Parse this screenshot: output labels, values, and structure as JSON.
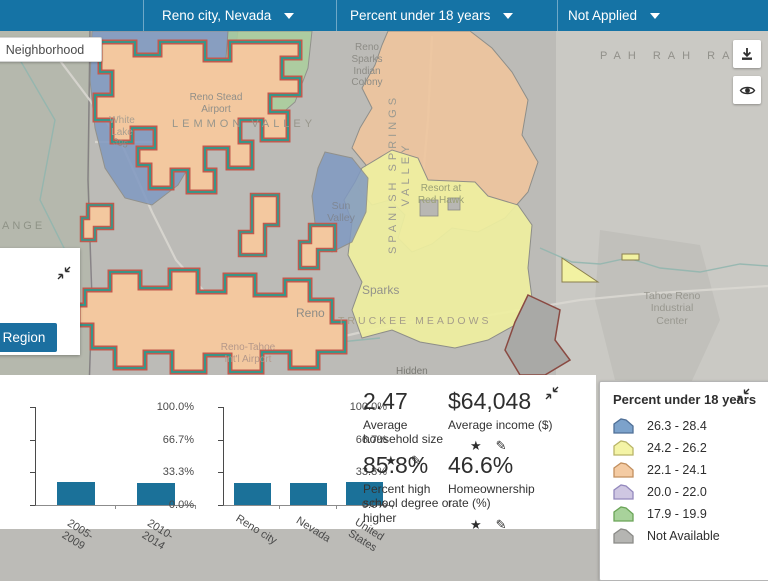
{
  "header": {
    "selectors": [
      {
        "label": "Reno city, Nevada"
      },
      {
        "label": "Percent under 18 years"
      },
      {
        "label": "Not Applied"
      }
    ]
  },
  "map": {
    "mode_button": "Neighborhood",
    "edit_button": "Edit Region",
    "labels": {
      "pah_rah": "PAH RAH RAN",
      "reno_sparks_colony": "Reno Sparks Indian Colony",
      "reno_stead": "Reno Stead Airport",
      "white_lake": "White Lake",
      "lemmon_valley": "LEMMON VALLEY",
      "spanish_springs": "SPANISH SPRINGS VALLEY",
      "sun_valley": "Sun Valley",
      "red_hawk": "Resort at Red Hawk",
      "sparks": "Sparks",
      "reno": "Reno",
      "truckee": "TRUCKEE MEADOWS",
      "reno_tahoe": "Reno-Tahoe Int'l Airport",
      "hidden": "Hidden",
      "tahoe_industrial": "Tahoe Reno Industrial Center",
      "ange": "ANGE",
      "hwy": "395"
    }
  },
  "legend": {
    "title": "Percent under 18 years",
    "items": [
      {
        "label": "26.3 - 28.4",
        "fill": "#7ca2cb",
        "stroke": "#4f6f96"
      },
      {
        "label": "24.2 - 26.2",
        "fill": "#f4f4a6",
        "stroke": "#b9b568"
      },
      {
        "label": "22.1 - 24.1",
        "fill": "#f4cba3",
        "stroke": "#c28f5e"
      },
      {
        "label": "20.0 - 22.0",
        "fill": "#cfc7e2",
        "stroke": "#9388bd"
      },
      {
        "label": "17.9 - 19.9",
        "fill": "#a8d29b",
        "stroke": "#6aa457"
      },
      {
        "label": "Not Available",
        "fill": "#b5b5b2",
        "stroke": "#8a8a87"
      }
    ]
  },
  "stats": {
    "items": [
      {
        "value": "2.47",
        "label": "Average household size"
      },
      {
        "value": "$64,048",
        "label": "Average income ($)"
      },
      {
        "value": "85.8%",
        "label": "Percent high school degree or higher"
      },
      {
        "value": "46.6%",
        "label": "Homeownership rate (%)"
      }
    ]
  },
  "chart_data": [
    {
      "type": "bar",
      "categories": [
        "2005-2009",
        "2010-2014"
      ],
      "values": [
        23.0,
        22.6
      ],
      "ytick_labels": [
        "0.0%",
        "33.3%",
        "66.7%",
        "100.0%"
      ],
      "ylim": [
        0,
        100
      ],
      "bar_color": "#1b7199"
    },
    {
      "type": "bar",
      "categories": [
        "Reno city",
        "Nevada",
        "United States"
      ],
      "values": [
        22.3,
        22.9,
        23.0
      ],
      "ytick_labels": [
        "0.0%",
        "33.3%",
        "66.7%",
        "100.0%"
      ],
      "ylim": [
        0,
        100
      ],
      "bar_color": "#1b7199"
    }
  ]
}
